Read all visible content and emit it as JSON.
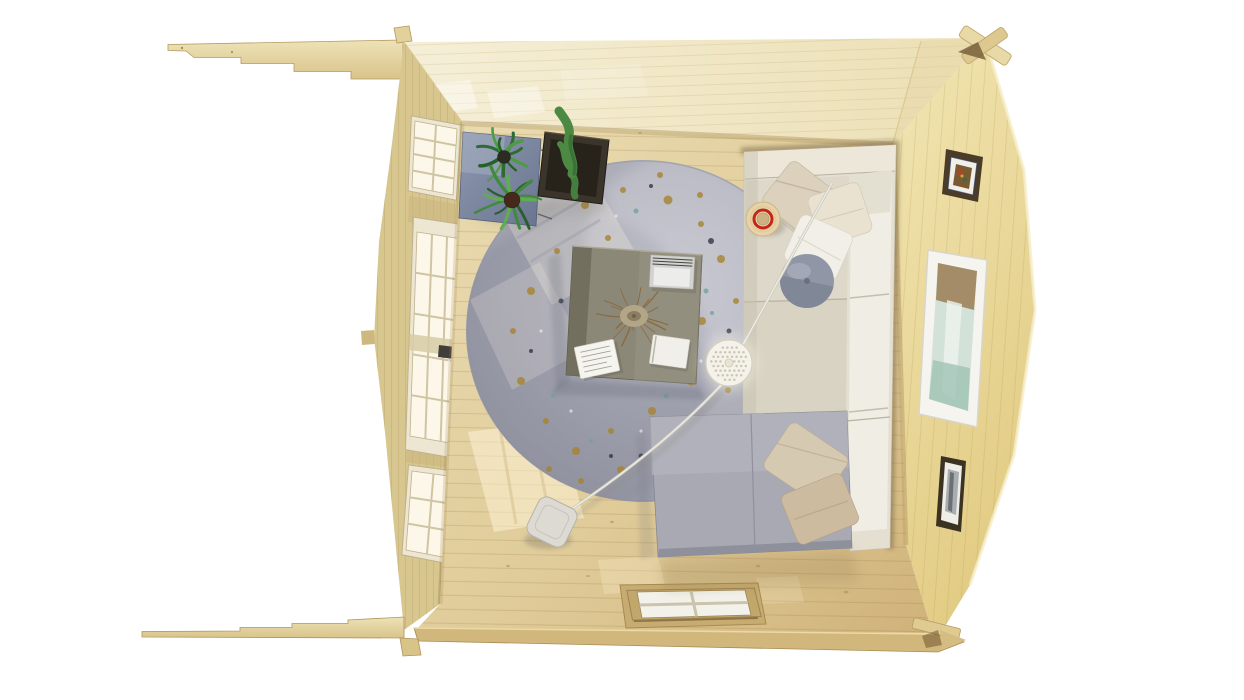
{
  "scene": {
    "title": "Top-down 3D render of a log cabin garden room interior",
    "objects": [
      "roof-overhang-beam-top",
      "roof-overhang-beam-bottom",
      "corner-log-joint-top-right",
      "corner-log-joint-bottom-right",
      "back-wall",
      "right-wall",
      "left-wall",
      "glazed-door-left-wall",
      "door-handle",
      "window-left-wall-top",
      "window-left-wall-bottom",
      "front-door-top-view",
      "wood-floor",
      "sunlight-patches",
      "round-speckled-rug",
      "corner-sofa",
      "chaise-section",
      "scatter-pillows",
      "round-blue-pillow",
      "straw-hat-with-red-band",
      "coffee-table",
      "dried-twig-centerpiece",
      "notepad",
      "magazine-stack",
      "white-book",
      "arc-floor-lamp",
      "perforated-lamp-shade",
      "lamp-base",
      "plant-stand",
      "potted-palm-plants",
      "cactus-in-dark-planter",
      "picture-frame-small-top",
      "framed-art-large",
      "picture-frame-small-bottom"
    ],
    "palette": {
      "background": "#ffffff",
      "wood_beam": "#e8daa8",
      "wood_beam_edge": "#b49a62",
      "back_wall": "#f2ead0",
      "right_wall": "#ecdc9c",
      "left_wall": "#d8c68f",
      "floor_light": "#eadcb2",
      "floor_dark": "#d5bb85",
      "front_wall_edge": "#d2b77c",
      "rug_base": "#a7a8b3",
      "sofa_cream": "#e4dfd0",
      "sofa_white": "#efede4",
      "chaise_gray": "#a8a9b3",
      "pillow_beige": "#dcd1bc",
      "pillow_tan": "#ccbb9e",
      "pillow_blue": "#9096a5",
      "table_top": "#8c8878",
      "lamp_white": "#f4f2ea",
      "hat_straw": "#e8d3a6",
      "hat_band": "#c1281a",
      "plant_green": "#3f8a3c",
      "cactus_green": "#4c8a44",
      "planter_dark": "#3b342a",
      "stand_blue": "#7e89a3",
      "frame_dark": "#463a28",
      "frame_white": "#f5f4ef",
      "art_teal": "#9fc3b4",
      "handle_dark": "#3f3e3a"
    },
    "windows": [
      {
        "id": "left-window-top",
        "quad": [
          [
            415,
            121
          ],
          [
            457,
            129
          ],
          [
            453,
            195
          ],
          [
            412,
            187
          ]
        ],
        "cols": 2,
        "rows": 4,
        "frame": "#ece6d2",
        "frameStroke": "#bfb28c",
        "pane": "#fcf7e8",
        "mullion": "#cfc5a4",
        "mw": 2
      },
      {
        "id": "left-door-glazing",
        "quad": [
          [
            417,
            232
          ],
          [
            462,
            239
          ],
          [
            456,
            444
          ],
          [
            410,
            436
          ]
        ],
        "cols": 3,
        "rows": 5,
        "frame": "#ece6d2",
        "frameStroke": "#bfb28c",
        "pane": "#fcf7e8",
        "mullion": "#cfc5a4",
        "mw": 2
      },
      {
        "id": "left-window-bottom",
        "quad": [
          [
            412,
            471
          ],
          [
            455,
            477
          ],
          [
            448,
            558
          ],
          [
            406,
            550
          ]
        ],
        "cols": 2,
        "rows": 3,
        "frame": "#ece6d2",
        "frameStroke": "#bfb28c",
        "pane": "#fcf7e8",
        "mullion": "#cfc5a4",
        "mw": 2
      },
      {
        "id": "front-door-panes",
        "quad": [
          [
            637,
            592
          ],
          [
            745,
            590
          ],
          [
            751,
            615
          ],
          [
            642,
            618
          ]
        ],
        "cols": 2,
        "rows": 2,
        "frame": "#c2a76d",
        "frameStroke": "#9d8350",
        "pane": "#f3f2ea",
        "mullion": "#cbc3ae",
        "mw": 3
      }
    ],
    "rug": {
      "cx": 643,
      "cy": 331,
      "rx": 177,
      "ry": 171,
      "speckles": {
        "gold": {
          "color": "#a8822f",
          "opacity": 0.8,
          "dots": [
            [
              585,
              205,
              4
            ],
            [
              623,
              190,
              3
            ],
            [
              668,
              200,
              4.5
            ],
            [
              701,
              224,
              3
            ],
            [
              721,
              259,
              4
            ],
            [
              736,
              301,
              3
            ],
            [
              702,
              321,
              4
            ],
            [
              661,
              344,
              3
            ],
            [
              691,
              381,
              4.5
            ],
            [
              652,
              411,
              4
            ],
            [
              611,
              431,
              3
            ],
            [
              576,
              451,
              4
            ],
            [
              546,
              421,
              3
            ],
            [
              521,
              381,
              4
            ],
            [
              513,
              331,
              3
            ],
            [
              531,
              291,
              4
            ],
            [
              557,
              251,
              3
            ],
            [
              601,
              269,
              2.5
            ],
            [
              608,
              238,
              3
            ],
            [
              688,
              263,
              3
            ],
            [
              716,
              351,
              3.5
            ],
            [
              673,
              431,
              3
            ],
            [
              621,
              470,
              4
            ],
            [
              581,
              481,
              3
            ],
            [
              549,
              469,
              3
            ],
            [
              660,
              175,
              3
            ],
            [
              700,
              195,
              3
            ],
            [
              728,
              390,
              3
            ]
          ]
        },
        "dark": {
          "color": "#2f3545",
          "opacity": 0.8,
          "dots": [
            [
              599,
              196,
              2.5
            ],
            [
              651,
              186,
              2
            ],
            [
              711,
              241,
              3
            ],
            [
              729,
              331,
              2.5
            ],
            [
              700,
              421,
              2.5
            ],
            [
              641,
              456,
              2.5
            ],
            [
              561,
              301,
              2.5
            ],
            [
              531,
              351,
              2
            ],
            [
              611,
              456,
              2
            ]
          ]
        },
        "teal": {
          "color": "#74a39b",
          "opacity": 0.8,
          "dots": [
            [
              636,
              211,
              2.5
            ],
            [
              706,
              291,
              2.5
            ],
            [
              666,
              396,
              2.5
            ],
            [
              553,
              396,
              2
            ],
            [
              591,
              441,
              2
            ],
            [
              712,
              313,
              2
            ]
          ]
        },
        "light": {
          "color": "#e9e9ee",
          "opacity": 0.7,
          "dots": [
            [
              616,
              216,
              1.6
            ],
            [
              691,
              311,
              1.6
            ],
            [
              641,
              431,
              1.6
            ],
            [
              541,
              331,
              1.6
            ],
            [
              701,
              361,
              1.6
            ],
            [
              571,
              411,
              1.6
            ]
          ]
        }
      }
    },
    "plants": [
      {
        "id": "plant-1",
        "cx": 504,
        "cy": 155,
        "leaves": 11,
        "lmin": 18,
        "lmax": 34,
        "seed": 7,
        "colors": [
          "#2e6b33",
          "#4f9a45",
          "#246128"
        ],
        "potR": 6.5,
        "potColor": "#2e2b24"
      },
      {
        "id": "plant-2",
        "cx": 512,
        "cy": 198,
        "leaves": 13,
        "lmin": 22,
        "lmax": 42,
        "seed": 13,
        "colors": [
          "#3f8a3c",
          "#5fae4e",
          "#2a5e2e"
        ],
        "potR": 8,
        "potColor": "#46291a"
      }
    ],
    "twigs": {
      "cx": 634,
      "cy": 316,
      "count": 16,
      "lmin": 18,
      "lmax": 42,
      "seed": 5,
      "color": "#8a683c"
    },
    "lamp": {
      "cx": 729,
      "cy": 363,
      "r": 23,
      "gap": 4.6,
      "holeR": 1.25,
      "holeColor": "#c6bfa8"
    }
  }
}
